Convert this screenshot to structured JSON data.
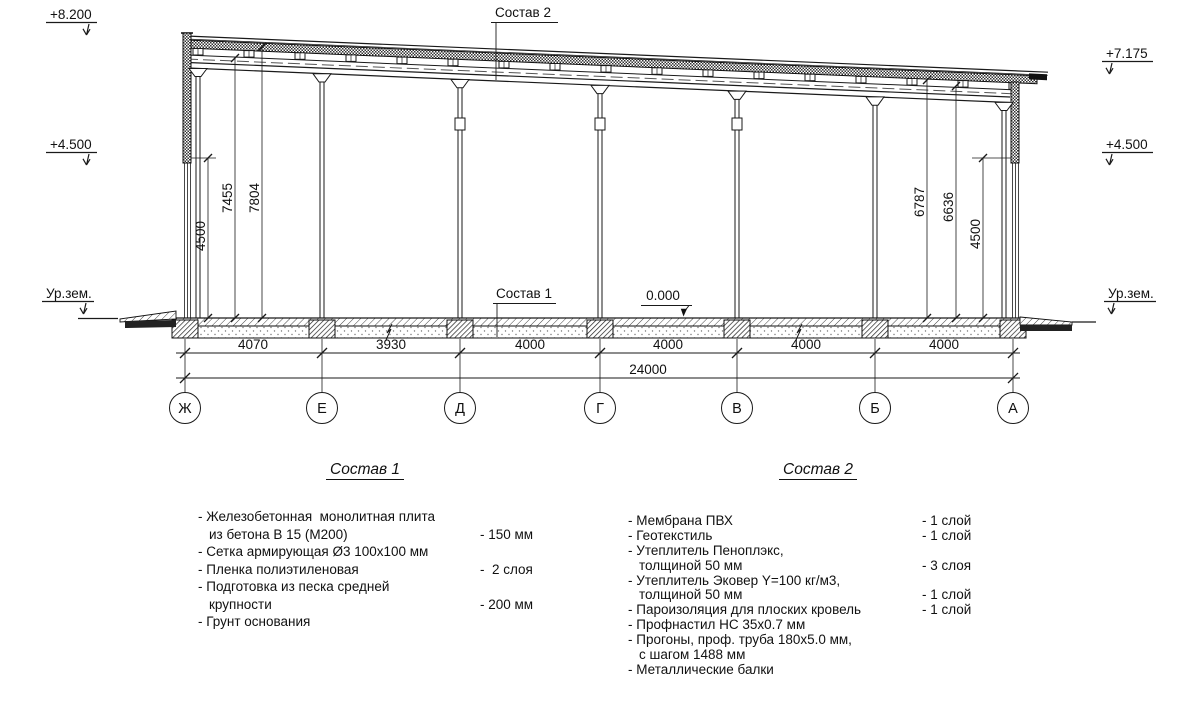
{
  "drawing": {
    "levels": {
      "top_left": "+8.200",
      "mid_left": "+4.500",
      "ground_left": "Ур.зем.",
      "top_right": "+7.175",
      "mid_right": "+4.500",
      "ground_right": "Ур.зем."
    },
    "callouts": {
      "roof": "Состав 2",
      "floor": "Состав 1",
      "zero": "0.000"
    },
    "vdims": {
      "left": [
        "4500",
        "7455",
        "7804"
      ],
      "right": [
        "6787",
        "6636",
        "4500"
      ]
    },
    "spans": [
      "4070",
      "3930",
      "4000",
      "4000",
      "4000",
      "4000"
    ],
    "total": "24000",
    "axes": [
      "Ж",
      "Е",
      "Д",
      "Г",
      "В",
      "Б",
      "А"
    ]
  },
  "spec1": {
    "title": "Состав 1",
    "rows": [
      {
        "t": "- Железобетонная  монолитная плита",
        "v": ""
      },
      {
        "t": "из бетона В 15 (М200)",
        "v": "- 150 мм"
      },
      {
        "t": "- Сетка армирующая Ø3 100x100 мм",
        "v": ""
      },
      {
        "t": "- Пленка полиэтиленовая",
        "v": "-  2 слоя"
      },
      {
        "t": "- Подготовка из песка средней",
        "v": ""
      },
      {
        "t": "крупности",
        "v": "- 200 мм"
      },
      {
        "t": "- Грунт основания",
        "v": ""
      }
    ]
  },
  "spec2": {
    "title": "Состав 2",
    "rows": [
      {
        "t": "- Мембрана ПВХ",
        "v": "- 1 слой"
      },
      {
        "t": "- Геотекстиль",
        "v": "- 1 слой"
      },
      {
        "t": "- Утеплитель Пеноплэкс,",
        "v": ""
      },
      {
        "t": "толщиной 50 мм",
        "v": "- 3 слоя"
      },
      {
        "t": "- Утеплитель Эковер Y=100 кг/м3,",
        "v": ""
      },
      {
        "t": "толщиной 50 мм",
        "v": "- 1 слой"
      },
      {
        "t": "- Пароизоляция для плоских кровель",
        "v": "- 1 слой"
      },
      {
        "t": "- Профнастил НС 35x0.7 мм",
        "v": ""
      },
      {
        "t": "- Прогоны, проф. труба 180x5.0 мм,",
        "v": ""
      },
      {
        "t": "с шагом 1488 мм",
        "v": ""
      },
      {
        "t": "- Металлические балки",
        "v": ""
      }
    ]
  }
}
